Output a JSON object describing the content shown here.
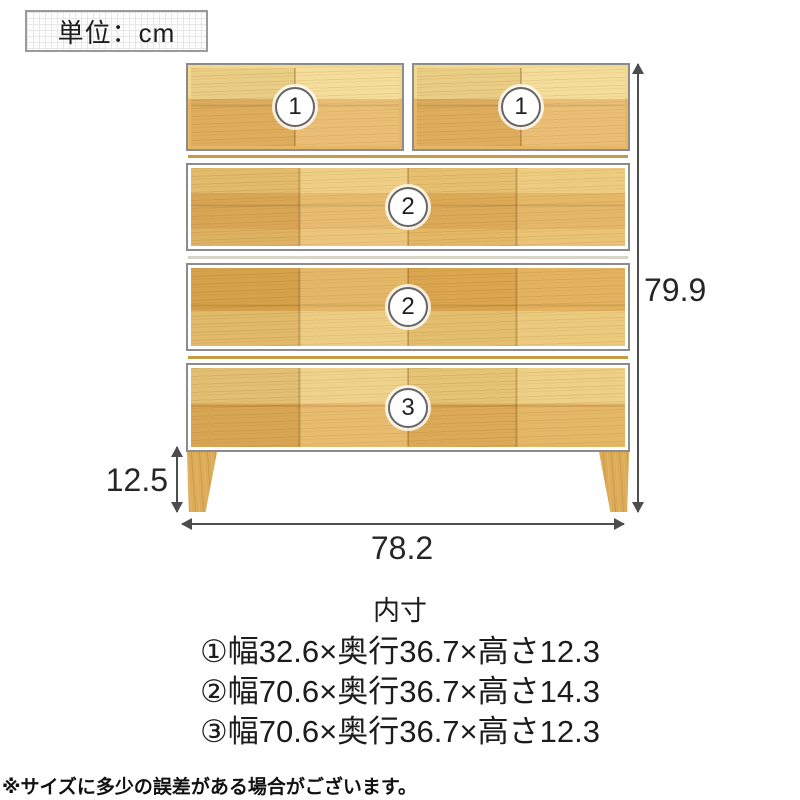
{
  "unit": {
    "label": "単位：cm"
  },
  "chest": {
    "badges": [
      "1",
      "1",
      "2",
      "2",
      "3"
    ]
  },
  "dimensions": {
    "height": "79.9",
    "width": "78.2",
    "leg_height": "12.5"
  },
  "inner_dimensions": {
    "title": "内寸",
    "items": [
      "①幅32.6×奥行36.7×高さ12.3",
      "②幅70.6×奥行36.7×高さ14.3",
      "③幅70.6×奥行36.7×高さ12.3"
    ]
  },
  "note": "※サイズに多少の誤差がある場合がございます。",
  "colors": {
    "wood_base": "#e4b464",
    "wood_light": "#f3d98f",
    "drawer_border": "#8c8c8c",
    "dimension_line": "#4d4d4d",
    "text": "#1f1f1f"
  }
}
